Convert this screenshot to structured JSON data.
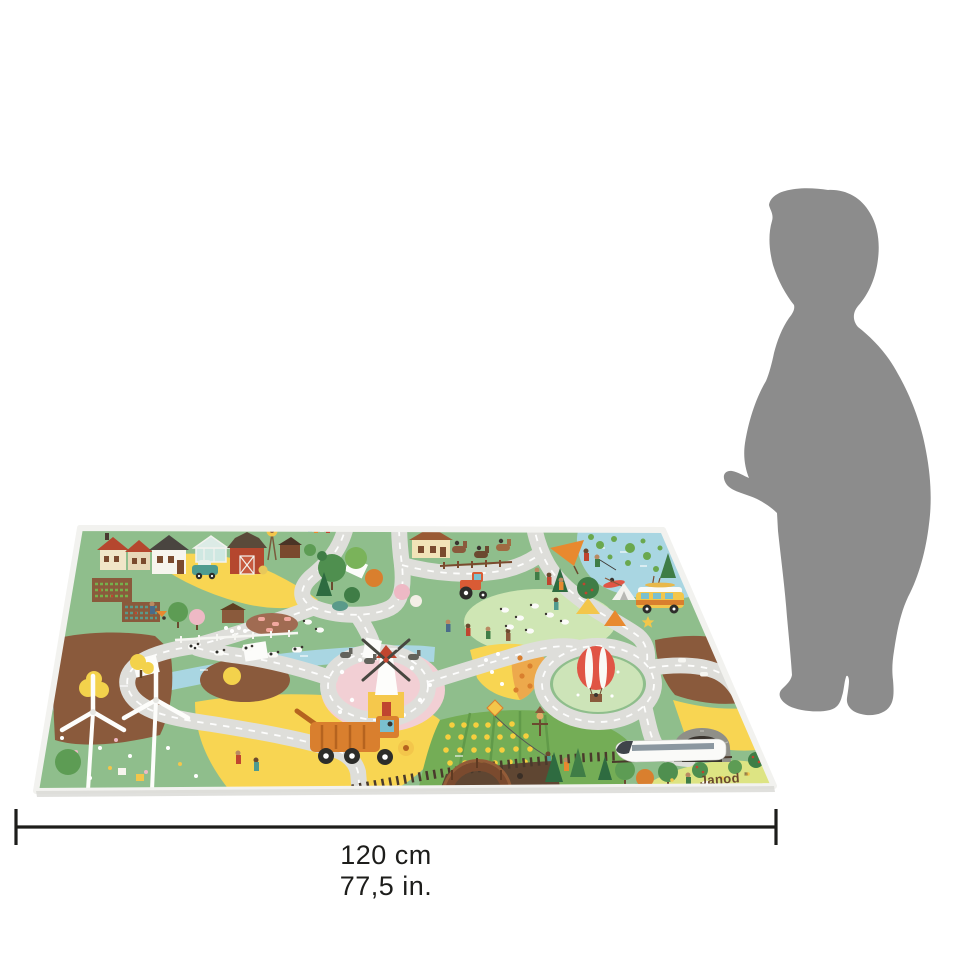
{
  "mat": {
    "brand_label": "Janod",
    "brand_reg_mark": "®"
  },
  "dimension": {
    "width_cm_label": "120 cm",
    "width_in_label": "77,5 in."
  },
  "colors": {
    "background": "#ffffff",
    "silhouette_gray": "#8c8c8c",
    "mat_base_green": "#8fbe8c",
    "road_gray": "#dededa",
    "road_dash_white": "#ffffff",
    "river_blue": "#a9d6e2",
    "field_yellow": "#f8d552",
    "soil_brown": "#8a5a3c",
    "meadow_light_green": "#cfe6b4",
    "mat_edge_white": "#f2f2ef",
    "barn_red": "#b5472e",
    "logo_brown": "#6b4a2f",
    "dimension_dark": "#1d1d1b"
  }
}
